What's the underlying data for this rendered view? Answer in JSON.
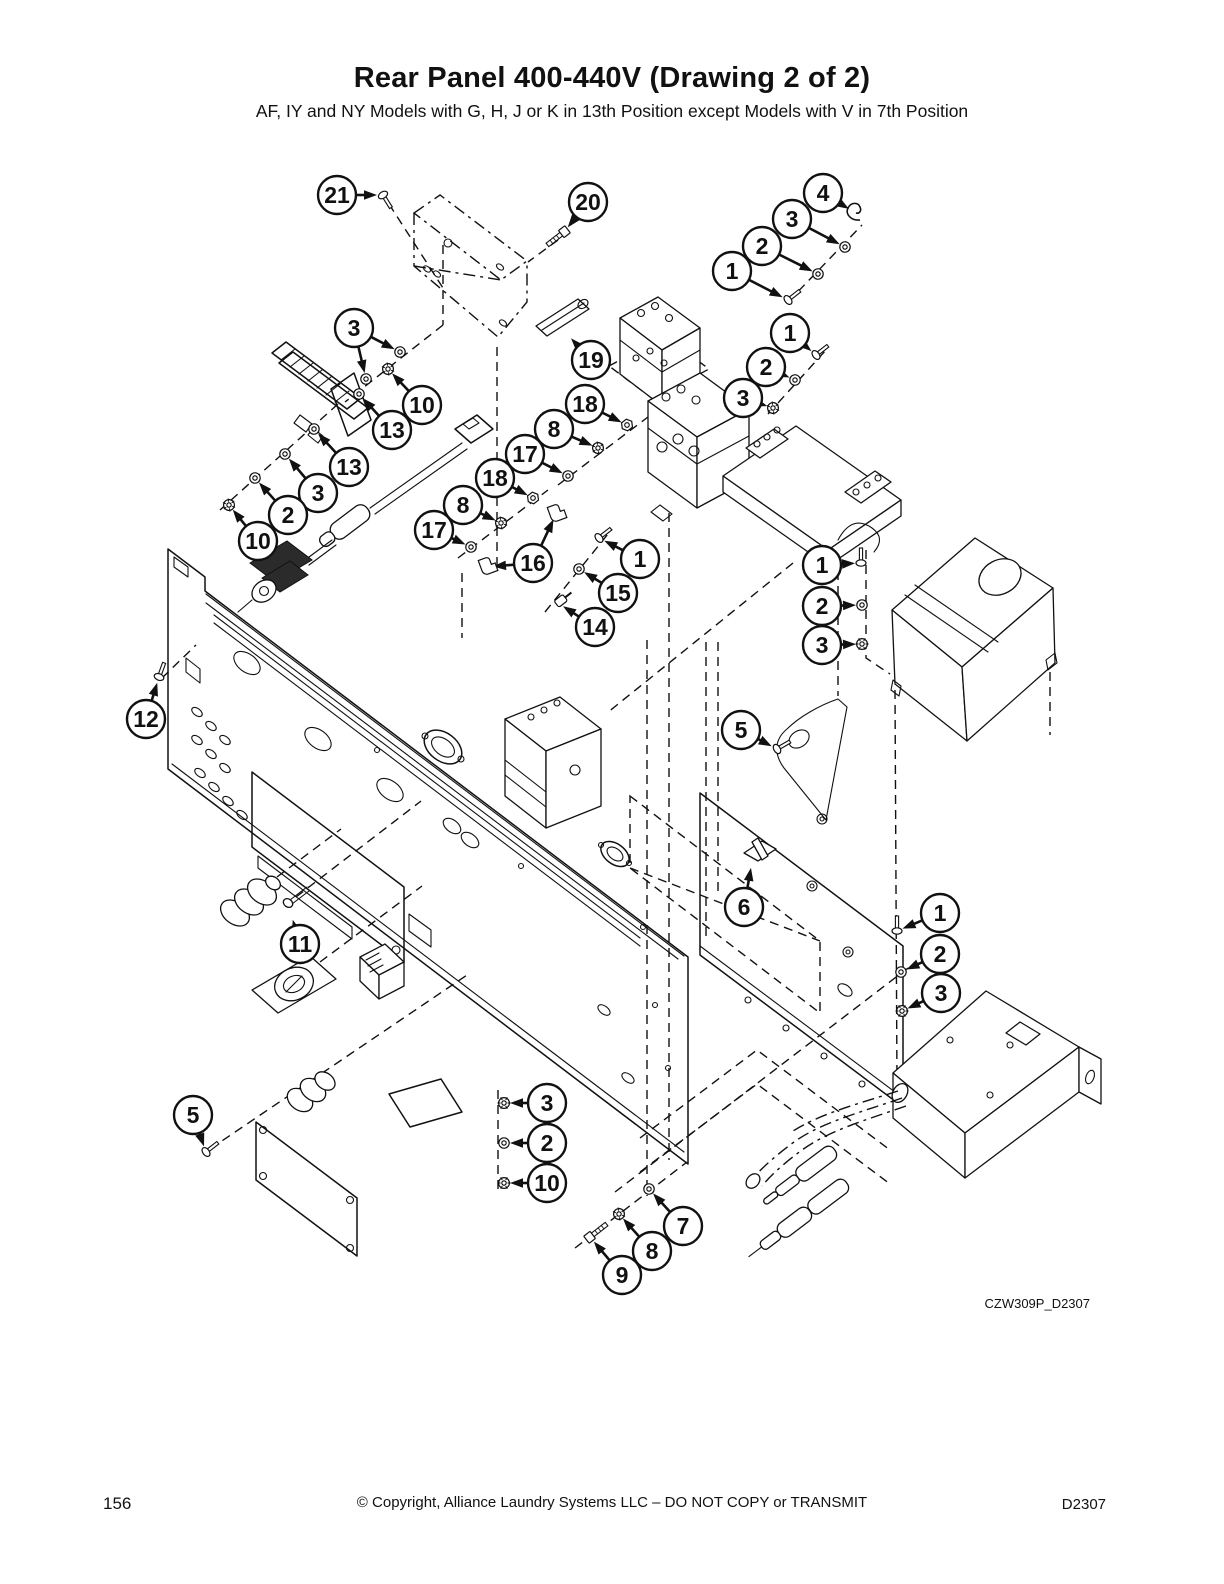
{
  "page": {
    "title": "Rear Panel 400-440V (Drawing 2 of 2)",
    "subtitle": "AF, IY and NY Models with G, H, J or K in 13th Position except Models with V in 7th Position",
    "figure_code": "CZW309P_D2307",
    "footer": {
      "page_number": "156",
      "copyright": "© Copyright, Alliance Laundry Systems LLC – DO NOT COPY or TRANSMIT",
      "doc_code": "D2307"
    }
  },
  "diagram": {
    "ink_color": "#111111",
    "balloon": {
      "radius": 19,
      "stroke_width": 2.4,
      "font_size": 23
    },
    "callouts": [
      {
        "label": "21",
        "x": 337,
        "y": 195,
        "targets": [
          [
            383,
            195
          ]
        ],
        "glyph": "screw",
        "angle": 58
      },
      {
        "label": "20",
        "x": 588,
        "y": 202,
        "targets": [
          [
            564,
            232
          ]
        ],
        "glyph": "bolt",
        "angle": 142
      },
      {
        "label": "4",
        "x": 823,
        "y": 193,
        "targets": [
          [
            854,
            212
          ]
        ],
        "glyph": "clamp",
        "angle": 0
      },
      {
        "label": "3",
        "x": 792,
        "y": 219,
        "targets": [
          [
            845,
            247
          ]
        ],
        "glyph": "washer",
        "angle": -38
      },
      {
        "label": "2",
        "x": 762,
        "y": 246,
        "targets": [
          [
            818,
            274
          ]
        ],
        "glyph": "washer",
        "angle": -38
      },
      {
        "label": "1",
        "x": 732,
        "y": 271,
        "targets": [
          [
            788,
            300
          ]
        ],
        "glyph": "screw",
        "angle": -38
      },
      {
        "label": "3",
        "x": 354,
        "y": 328,
        "targets": [
          [
            400,
            352
          ],
          [
            366,
            379
          ]
        ],
        "glyph": "washer",
        "angle": -38
      },
      {
        "label": "10",
        "x": 422,
        "y": 405,
        "targets": [
          [
            388,
            369
          ]
        ],
        "glyph": "lockwasher",
        "angle": -38
      },
      {
        "label": "13",
        "x": 392,
        "y": 430,
        "targets": [
          [
            359,
            394
          ]
        ],
        "glyph": "washer",
        "angle": -38
      },
      {
        "label": "13",
        "x": 349,
        "y": 467,
        "targets": [
          [
            314,
            429
          ]
        ],
        "glyph": "washer",
        "angle": -38
      },
      {
        "label": "3",
        "x": 318,
        "y": 493,
        "targets": [
          [
            285,
            454
          ]
        ],
        "glyph": "washer",
        "angle": -38
      },
      {
        "label": "2",
        "x": 288,
        "y": 515,
        "targets": [
          [
            255,
            478
          ]
        ],
        "glyph": "washer",
        "angle": -38
      },
      {
        "label": "10",
        "x": 258,
        "y": 541,
        "targets": [
          [
            229,
            505
          ]
        ],
        "glyph": "lockwasher",
        "angle": -38
      },
      {
        "label": "19",
        "x": 591,
        "y": 360,
        "targets": [
          [
            567,
            334
          ]
        ],
        "glyph": "none",
        "angle": 0
      },
      {
        "label": "18",
        "x": 585,
        "y": 404,
        "targets": [
          [
            627,
            425
          ]
        ],
        "glyph": "nut",
        "angle": -38
      },
      {
        "label": "8",
        "x": 554,
        "y": 429,
        "targets": [
          [
            598,
            448
          ]
        ],
        "glyph": "lockwasher",
        "angle": -38
      },
      {
        "label": "17",
        "x": 525,
        "y": 454,
        "targets": [
          [
            568,
            476
          ]
        ],
        "glyph": "washer",
        "angle": -38
      },
      {
        "label": "18",
        "x": 495,
        "y": 478,
        "targets": [
          [
            533,
            498
          ]
        ],
        "glyph": "nut",
        "angle": -38
      },
      {
        "label": "8",
        "x": 463,
        "y": 505,
        "targets": [
          [
            501,
            523
          ]
        ],
        "glyph": "lockwasher",
        "angle": -38
      },
      {
        "label": "17",
        "x": 434,
        "y": 530,
        "targets": [
          [
            471,
            547
          ]
        ],
        "glyph": "washer",
        "angle": -38
      },
      {
        "label": "16",
        "x": 533,
        "y": 563,
        "targets": [
          [
            487,
            567
          ],
          [
            556,
            514
          ]
        ],
        "glyph": "elbow",
        "angle": -20
      },
      {
        "label": "1",
        "x": 640,
        "y": 559,
        "targets": [
          [
            599,
            538
          ]
        ],
        "glyph": "screw",
        "angle": -38
      },
      {
        "label": "15",
        "x": 618,
        "y": 593,
        "targets": [
          [
            579,
            569
          ]
        ],
        "glyph": "washer",
        "angle": -38
      },
      {
        "label": "14",
        "x": 595,
        "y": 627,
        "targets": [
          [
            558,
            603
          ]
        ],
        "glyph": "lug",
        "angle": -38
      },
      {
        "label": "1",
        "x": 790,
        "y": 333,
        "targets": [
          [
            816,
            355
          ]
        ],
        "glyph": "screw",
        "angle": -38
      },
      {
        "label": "2",
        "x": 766,
        "y": 367,
        "targets": [
          [
            795,
            380
          ]
        ],
        "glyph": "washer",
        "angle": -38
      },
      {
        "label": "3",
        "x": 743,
        "y": 398,
        "targets": [
          [
            773,
            408
          ]
        ],
        "glyph": "lockwasher",
        "angle": -38
      },
      {
        "label": "1",
        "x": 822,
        "y": 565,
        "targets": [
          [
            861,
            563
          ]
        ],
        "glyph": "screw",
        "angle": -90
      },
      {
        "label": "2",
        "x": 822,
        "y": 606,
        "targets": [
          [
            862,
            605
          ]
        ],
        "glyph": "washer",
        "angle": 0
      },
      {
        "label": "3",
        "x": 822,
        "y": 645,
        "targets": [
          [
            862,
            644
          ]
        ],
        "glyph": "lockwasher",
        "angle": 0
      },
      {
        "label": "12",
        "x": 146,
        "y": 719,
        "targets": [
          [
            159,
            677
          ]
        ],
        "glyph": "screw",
        "angle": -70
      },
      {
        "label": "5",
        "x": 741,
        "y": 730,
        "targets": [
          [
            777,
            749
          ]
        ],
        "glyph": "screw",
        "angle": -30
      },
      {
        "label": "6",
        "x": 744,
        "y": 907,
        "targets": [
          [
            752,
            862
          ]
        ],
        "glyph": "none",
        "angle": 0
      },
      {
        "label": "11",
        "x": 300,
        "y": 944,
        "targets": [
          [
            291,
            914
          ]
        ],
        "glyph": "none",
        "angle": 0
      },
      {
        "label": "1",
        "x": 940,
        "y": 913,
        "targets": [
          [
            897,
            931
          ]
        ],
        "glyph": "screw",
        "angle": -90
      },
      {
        "label": "2",
        "x": 940,
        "y": 954,
        "targets": [
          [
            901,
            972
          ]
        ],
        "glyph": "washer",
        "angle": 0
      },
      {
        "label": "3",
        "x": 941,
        "y": 993,
        "targets": [
          [
            902,
            1011
          ]
        ],
        "glyph": "lockwasher",
        "angle": 0
      },
      {
        "label": "5",
        "x": 193,
        "y": 1115,
        "targets": [
          [
            206,
            1152
          ]
        ],
        "glyph": "screw",
        "angle": -38
      },
      {
        "label": "3",
        "x": 547,
        "y": 1103,
        "targets": [
          [
            504,
            1103
          ]
        ],
        "glyph": "lockwasher",
        "angle": 0
      },
      {
        "label": "2",
        "x": 547,
        "y": 1143,
        "targets": [
          [
            504,
            1143
          ]
        ],
        "glyph": "washer",
        "angle": 0
      },
      {
        "label": "10",
        "x": 547,
        "y": 1183,
        "targets": [
          [
            504,
            1183
          ]
        ],
        "glyph": "lockwasher",
        "angle": 0
      },
      {
        "label": "7",
        "x": 683,
        "y": 1226,
        "targets": [
          [
            649,
            1189
          ]
        ],
        "glyph": "washer",
        "angle": -38
      },
      {
        "label": "8",
        "x": 652,
        "y": 1251,
        "targets": [
          [
            619,
            1214
          ]
        ],
        "glyph": "lockwasher",
        "angle": -38
      },
      {
        "label": "9",
        "x": 622,
        "y": 1275,
        "targets": [
          [
            590,
            1237
          ]
        ],
        "glyph": "bolt",
        "angle": -38
      }
    ]
  }
}
